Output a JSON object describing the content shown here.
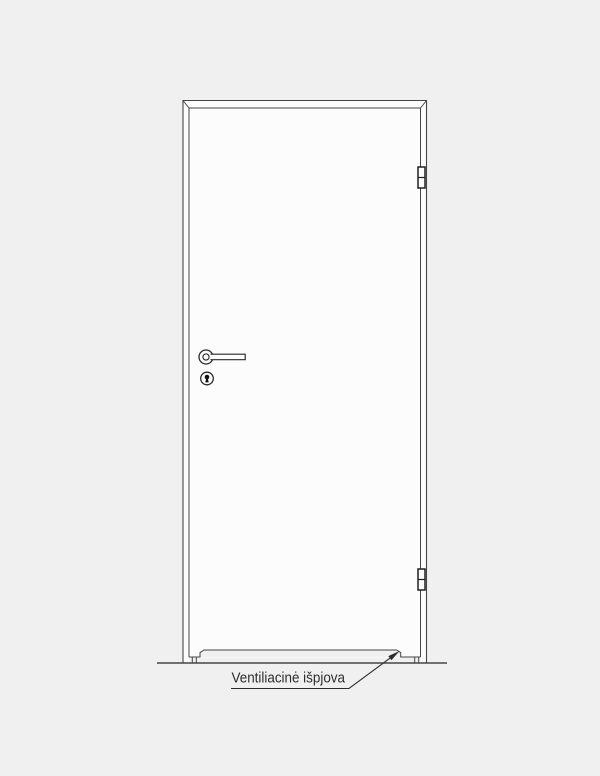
{
  "page": {
    "background_color": "#f0f0f0"
  },
  "drawing": {
    "kind": "door-technical-drawing-front-elevation",
    "line_color": "#454545",
    "hinge_line_color": "#1e1e1e",
    "door_fill_color": "#fcfcfc",
    "keyhole_fill_color": "#111111",
    "annotation": {
      "label": "Ventiliacinė išpjova",
      "text_color": "#2d2d2d"
    },
    "components": {
      "hinge_count": 2,
      "has_handle": true,
      "has_keyhole": true,
      "has_ventilation_cutout": true
    }
  }
}
